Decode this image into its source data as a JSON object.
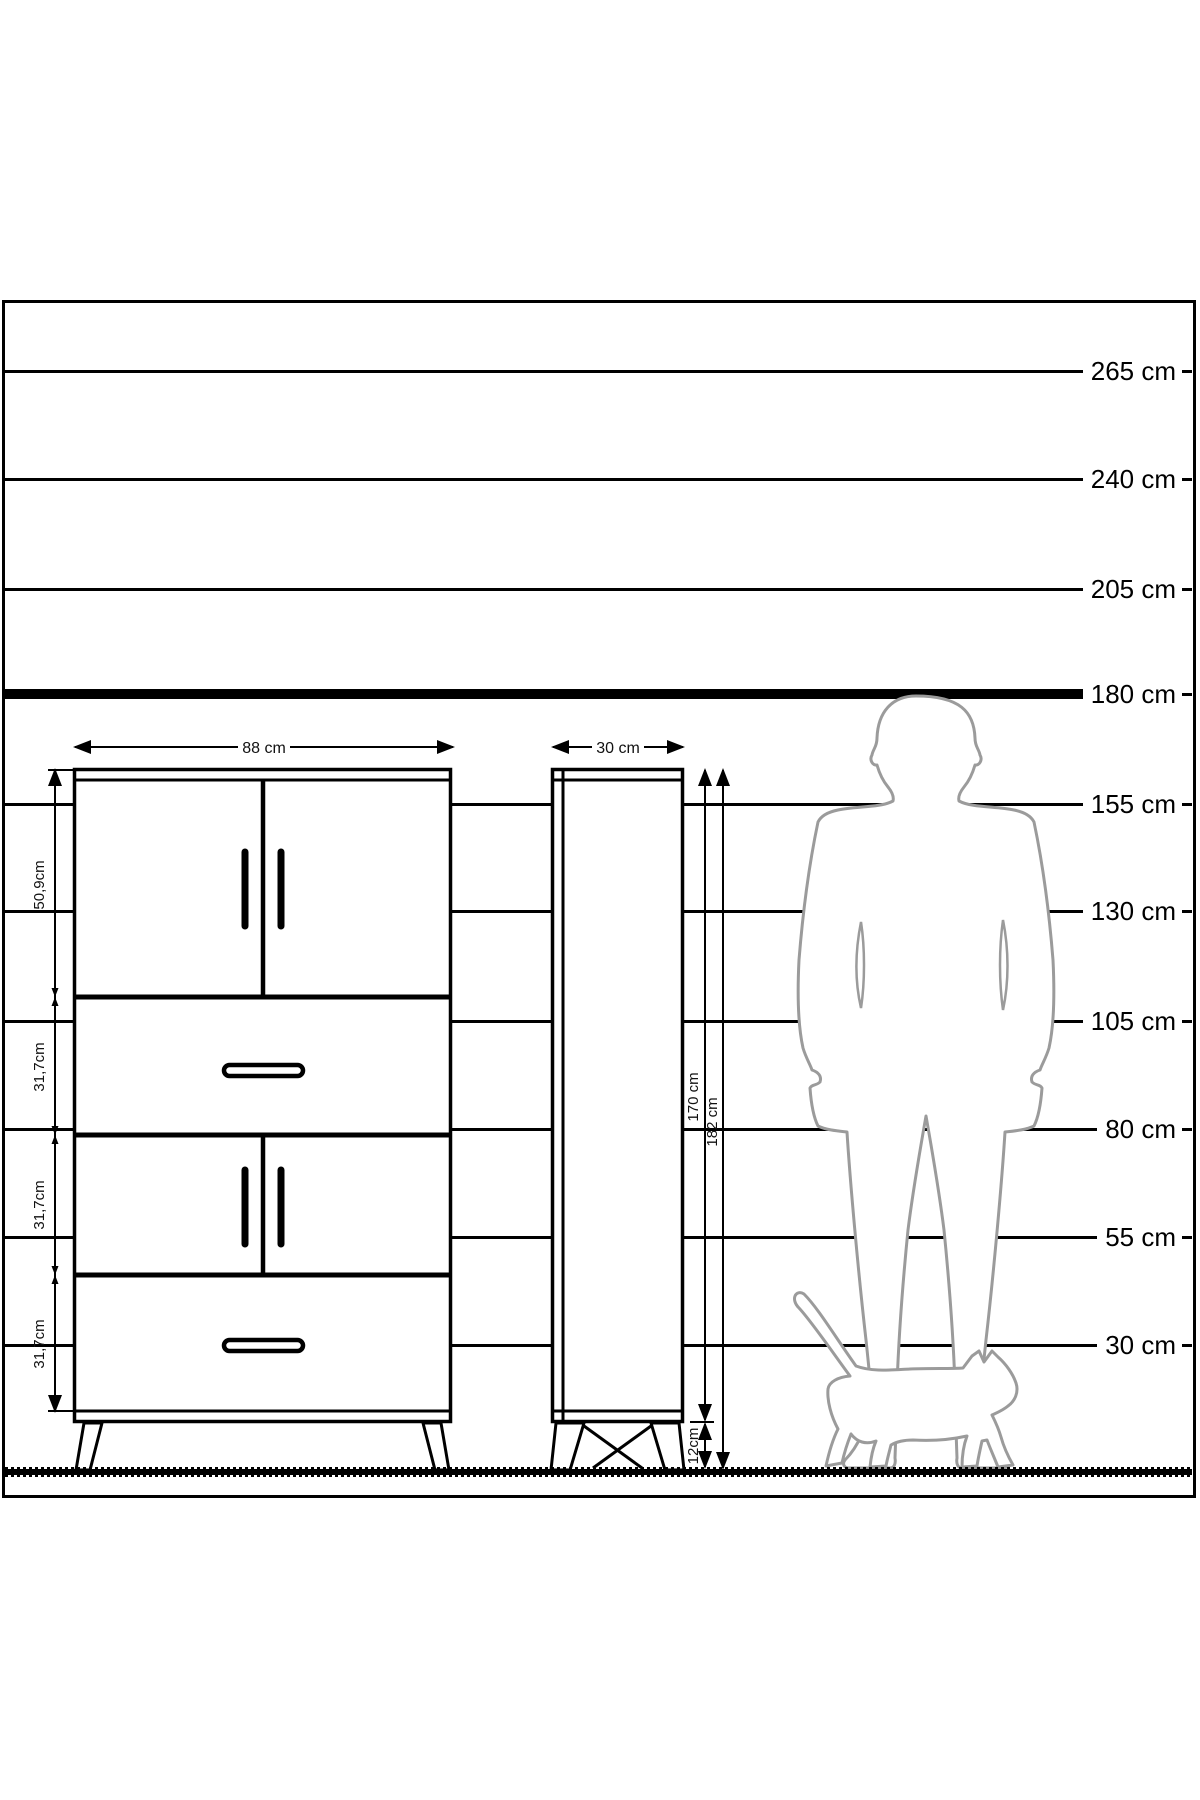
{
  "scale": {
    "labels": [
      "265 cm",
      "240 cm",
      "205 cm",
      "180 cm",
      "155 cm",
      "130 cm",
      "105 cm",
      "80 cm",
      "55 cm",
      "30 cm"
    ]
  },
  "front_view": {
    "width_label": "88 cm",
    "section_labels": [
      "50,9cm",
      "31,7cm",
      "31,7cm",
      "31,7cm"
    ]
  },
  "side_view": {
    "depth_label": "30 cm",
    "body_height_label": "170 cm",
    "total_height_label": "182 cm",
    "leg_height_label": "12cm"
  },
  "colors": {
    "line": "#000000",
    "silhouette": "#9b9b9b",
    "background": "#ffffff"
  }
}
